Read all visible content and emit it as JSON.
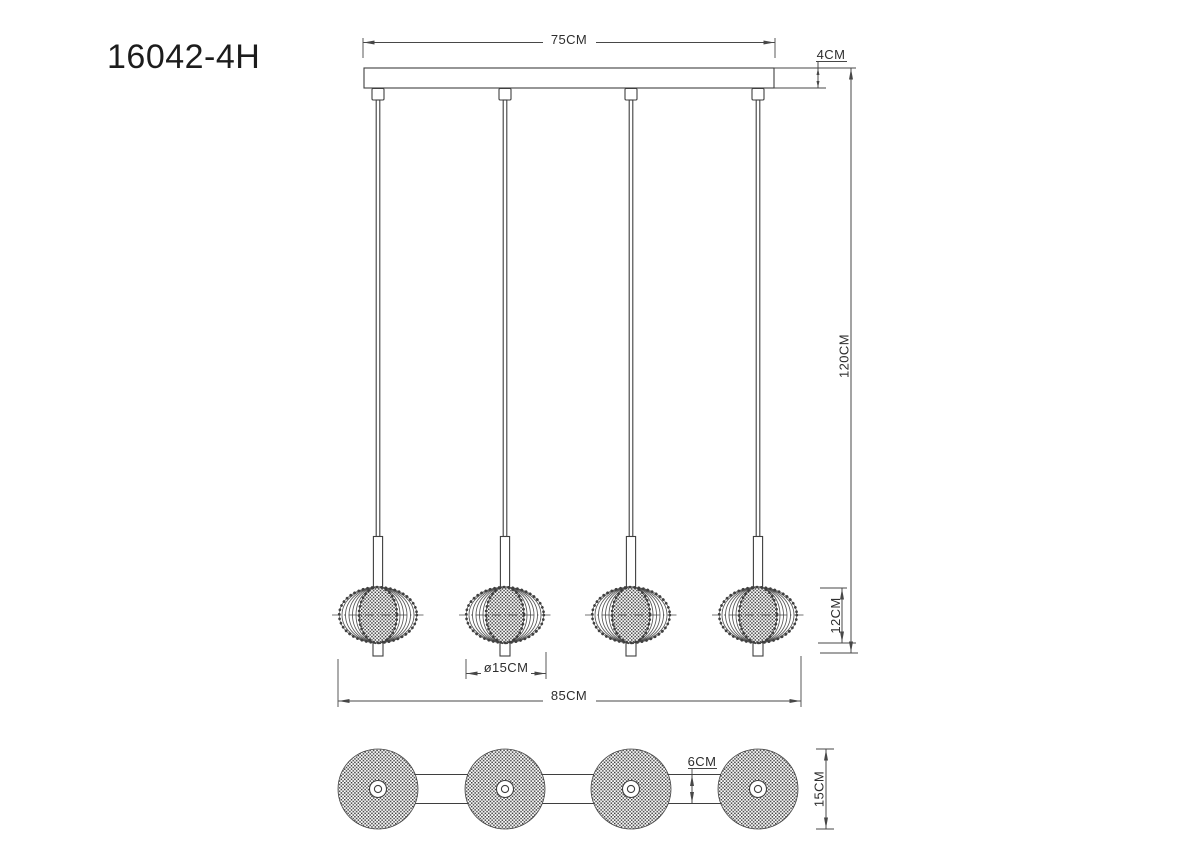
{
  "page": {
    "background": "#ffffff"
  },
  "drawing": {
    "model_number": "16042-4H",
    "line_color": "#3f3f3f",
    "dimension_color": "#474747",
    "text_color": "#2e2e2e",
    "pendant_count": 4
  },
  "views": {
    "front": {
      "canopy_width_label": "75CM",
      "canopy_height_label": "4CM",
      "drop_height_label": "120CM",
      "shade_height_label": "12CM",
      "shade_diameter_label": "ø15CM",
      "overall_width_label": "85CM"
    },
    "bottom": {
      "bar_depth_label": "6CM",
      "shade_diameter_label": "15CM"
    }
  }
}
